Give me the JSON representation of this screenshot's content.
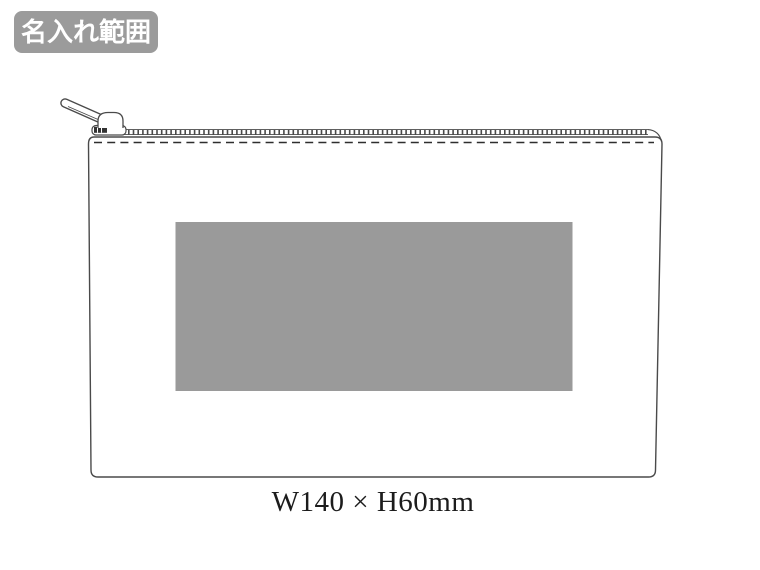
{
  "badge": {
    "label": "名入れ範囲",
    "bg_color": "#9b9b9b",
    "text_color": "#ffffff"
  },
  "pouch": {
    "dimension_label": "W140 × H60mm"
  },
  "colors": {
    "print_area": "#9a9a9a",
    "line": "#4a4a4a",
    "stitch": "#2e2e2e"
  }
}
